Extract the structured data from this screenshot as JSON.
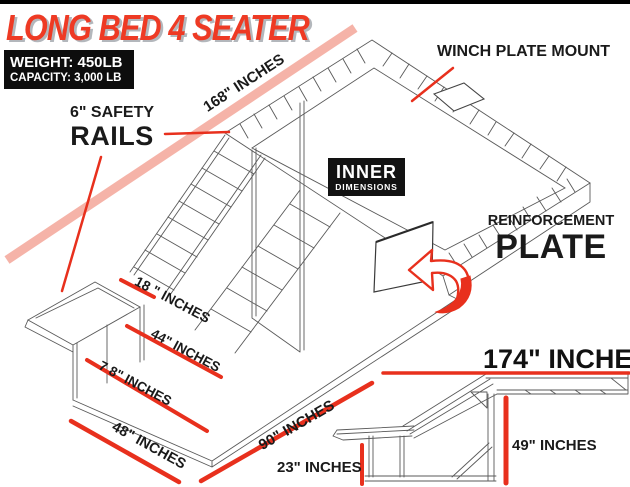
{
  "header": {
    "title": "LONG BED 4 SEATER",
    "weight": "WEIGHT: 450LB",
    "capacity": "CAPACITY: 3,000 LB"
  },
  "callouts": {
    "winch_plate": "WINCH PLATE MOUNT",
    "safety_top": "6\" SAFETY",
    "safety_bottom": "RAILS",
    "inner_top": "INNER",
    "inner_bottom": "DIMENSIONS",
    "reinforcement_top": "REINFORCEMENT",
    "reinforcement_bottom": "PLATE"
  },
  "dimensions": {
    "length_top": "168\" INCHES",
    "rail_18": "18 \" INCHES",
    "width_44": "44\" INCHES",
    "width_78": "7 8\" INCHES",
    "width_48": "48\" INCHES",
    "side_90": "90\" INCHES",
    "total_174": "174\" INCHES",
    "front_23": "23\" INCHES",
    "height_49": "49\" INCHES"
  },
  "icons": {
    "reinforcement_arrow": "curved-left-arrow"
  },
  "colors": {
    "accent_red": "#e8301d",
    "band_pink": "#f5b3a8",
    "title_red": "#ee3a24",
    "ink_black": "#111111",
    "frame_gray": "#5a5a5a"
  }
}
